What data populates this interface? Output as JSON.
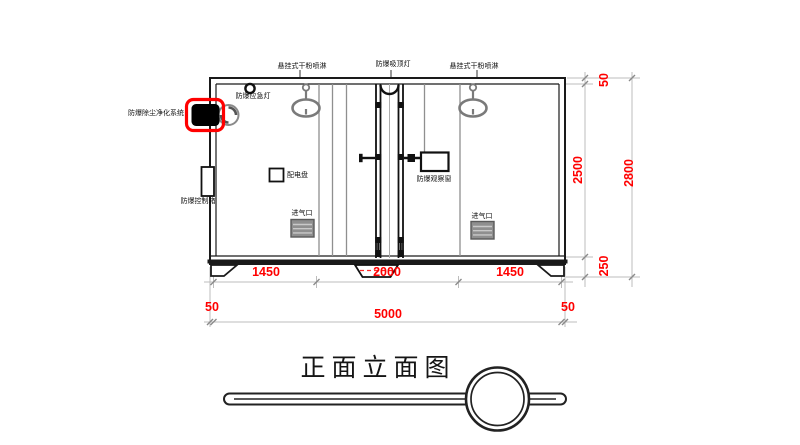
{
  "title": "正面立面图",
  "colors": {
    "dimension_text": "#ff0000",
    "highlight_outline": "#ff0000",
    "line": "#1a1a1a",
    "gray_component": "#7a7a7a"
  },
  "labels": {
    "sprinkler_left": "悬挂式干粉喷淋",
    "ceiling_lamp": "防爆吸顶灯",
    "sprinkler_right": "悬挂式干粉喷淋",
    "emergency_lamp": "防爆应急灯",
    "dust_system": "防爆除尘净化系统",
    "control_box": "防爆控制箱",
    "dist_panel": "配电盘",
    "observation_window": "防爆观察窗",
    "air_inlet_left": "进气口",
    "air_inlet_right": "进气口"
  },
  "dimensions": {
    "bottom_segments": [
      "1450",
      "2000",
      "1450"
    ],
    "bottom_total": [
      "50",
      "5000",
      "50"
    ],
    "right_segments": [
      "50",
      "2500",
      "250"
    ],
    "right_total": "2800"
  }
}
